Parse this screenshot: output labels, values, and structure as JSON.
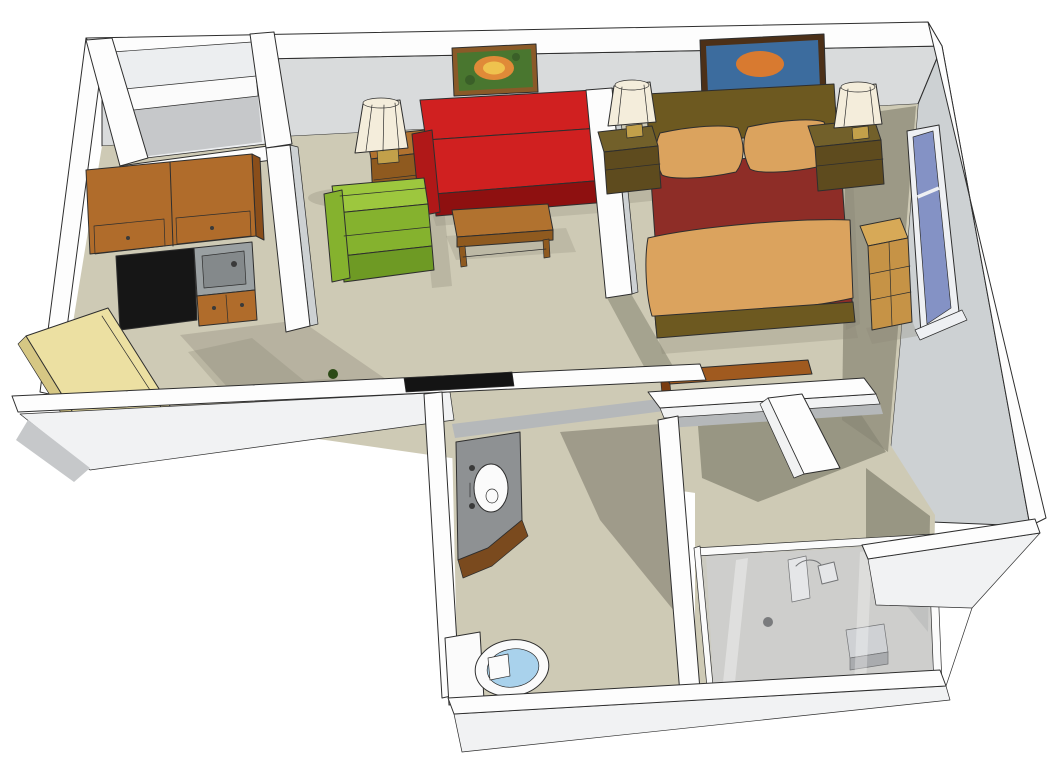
{
  "meta": {
    "description": "3D isometric cutaway floor plan of a studio apartment with kitchen, living area, bedroom, bathroom with shower, and closets"
  },
  "colors": {
    "bg": "#ffffff",
    "outline": "#2e2e2e",
    "wallTop": "#fdfdfd",
    "wallFace": "#d9dbdc",
    "wallFaceEast": "#cdd1d3",
    "wallFaceDark": "#b5b8ba",
    "wallOuter": "#f1f2f3",
    "wallShade": "#c6c8ca",
    "closetInner": "#eceef0",
    "closetShelf": "#fbfbfb",
    "floor": "#cecab5",
    "floorShadow": "#8b8877",
    "cabinetWood": "#b06c2b",
    "cabinetWoodDark": "#8a4e1a",
    "applianceBlack": "#161616",
    "counterGray": "#9aa0a2",
    "sinkBasin": "#84898b",
    "doorYellow": "#ece0a2",
    "doorEdge": "#d6c784",
    "sofaRed": "#d02020",
    "sofaRedDark": "#b01818",
    "sofaRedDeep": "#8e1010",
    "chairGreen": "#9dc73e",
    "chairGreenDark": "#85b22e",
    "chairGreenDeep": "#6e9a24",
    "tableWood": "#b1722f",
    "tableWoodDark": "#8f5a1f",
    "lampShade": "#f4eddb",
    "lampBase": "#c2a04a",
    "artFrameLiving": "#8a5a28",
    "artCanvasLiving": "#49762f",
    "artFlowerOuter": "#e08a38",
    "artFlowerInner": "#efc24e",
    "leafGreen": "#3a5f28",
    "artFrameBed": "#4c3018",
    "artCanvasBed": "#3c6c9e",
    "artSwirl": "#d87a30",
    "bedWood": "#6d5920",
    "bedWoodLight": "#8a7430",
    "beddingRed": "#8e2d27",
    "pillowTan": "#dba35e",
    "pillowEdge": "#9a7435",
    "nightstandWood": "#5e4b1e",
    "nightstandTop": "#72602a",
    "windowFrame": "#eef0f3",
    "windowPane": "#8492c5",
    "dresserWood": "#c69346",
    "dresserTop": "#d7a957",
    "deskWood": "#a05a1f",
    "deskWoodDark": "#7a3c10",
    "vanityGray": "#8e9193",
    "vanityTrim": "#7a4a1e",
    "porcelain": "#fbfbfb",
    "toiletBlue": "#a9d2ec",
    "showerGlass": "#c9cdd1",
    "showerTray": "#d4d6d8",
    "hardwareDark": "#3a3a3a",
    "plantGreen": "#2c4a16",
    "tvBlack": "#141414"
  },
  "scene": {
    "rooms": [
      {
        "name": "kitchen",
        "items": [
          "upper-cabinets",
          "refrigerator",
          "sink-counter",
          "base-cabinet",
          "entry-door",
          "entry-closet"
        ]
      },
      {
        "name": "living-area",
        "items": [
          "flower-painting",
          "side-table",
          "table-lamp",
          "red-sofa",
          "green-armchair",
          "coffee-table",
          "potted-plant",
          "wall-tv"
        ]
      },
      {
        "name": "bedroom",
        "items": [
          "abstract-painting",
          "double-bed",
          "left-nightstand",
          "right-nightstand",
          "two-bedside-lamps",
          "window",
          "dresser",
          "desk"
        ]
      },
      {
        "name": "bathroom",
        "items": [
          "corner-vanity-sink",
          "toilet",
          "shower-stall"
        ]
      },
      {
        "name": "closets",
        "items": [
          "walk-in-closet"
        ]
      }
    ]
  }
}
